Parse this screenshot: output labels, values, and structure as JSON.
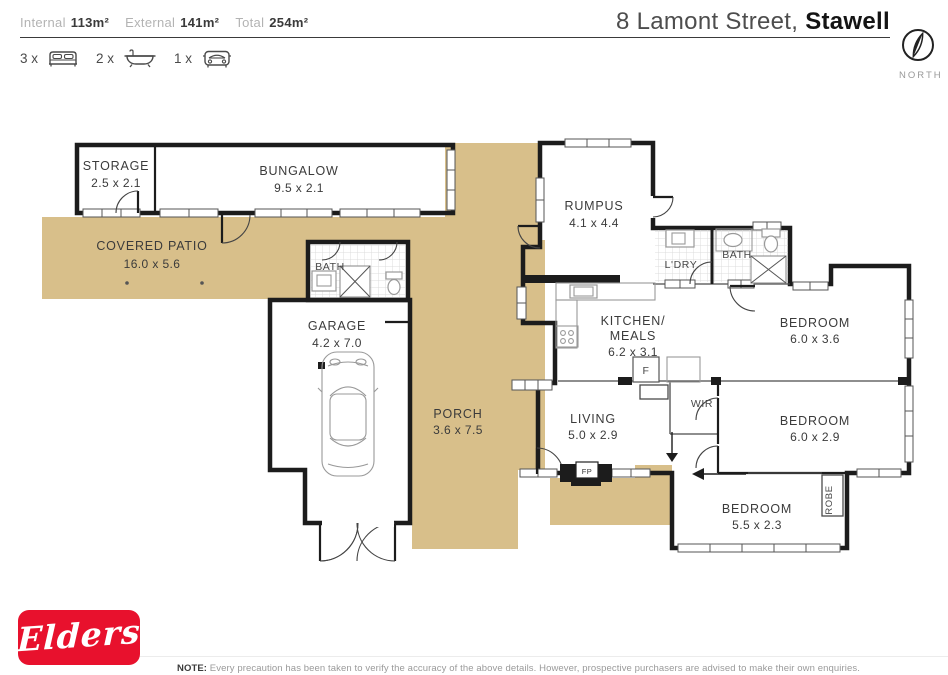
{
  "header": {
    "internal_label": "Internal",
    "internal_value": "113m²",
    "external_label": "External",
    "external_value": "141m²",
    "total_label": "Total",
    "total_value": "254m²",
    "address_regular": "8 Lamont Street, ",
    "address_bold": "Stawell",
    "compass_label": "NORTH",
    "beds_count": "3 x",
    "baths_count": "2 x",
    "cars_count": "1 x"
  },
  "rooms": {
    "storage": {
      "name": "STORAGE",
      "dims": "2.5 x 2.1"
    },
    "bungalow": {
      "name": "BUNGALOW",
      "dims": "9.5 x 2.1"
    },
    "covered_patio": {
      "name": "COVERED PATIO",
      "dims": "16.0 x 5.6"
    },
    "outdoor_bath": {
      "name": "BATH"
    },
    "garage": {
      "name": "GARAGE",
      "dims": "4.2 x 7.0"
    },
    "porch": {
      "name": "PORCH",
      "dims": "3.6 x 7.5"
    },
    "rumpus": {
      "name": "RUMPUS",
      "dims": "4.1 x 4.4"
    },
    "laundry": {
      "name": "L'DRY"
    },
    "bathroom": {
      "name": "BATH"
    },
    "kitchen": {
      "name_line1": "KITCHEN/",
      "name_line2": "MEALS",
      "dims": "6.2 x 3.1"
    },
    "living": {
      "name": "LIVING",
      "dims": "5.0 x 2.9"
    },
    "bedroom1": {
      "name": "BEDROOM",
      "dims": "6.0 x 3.6"
    },
    "bedroom2": {
      "name": "BEDROOM",
      "dims": "6.0 x 2.9"
    },
    "bedroom3": {
      "name": "BEDROOM",
      "dims": "5.5 x 2.3"
    },
    "wir": {
      "name": "WIR"
    },
    "robe": {
      "name": "ROBE"
    },
    "fireplace": {
      "name": "FP"
    },
    "fridge": {
      "name": "F"
    }
  },
  "footer": {
    "brand": "Elders",
    "note_label": "NOTE:",
    "note_text": " Every precaution has been taken to verify the accuracy of the above details. However, prospective purchasers are advised to make their own enquiries."
  },
  "colors": {
    "patio_tan": "#d8bf8a",
    "wall": "#1c1c1c",
    "brand_red": "#e8112d"
  }
}
